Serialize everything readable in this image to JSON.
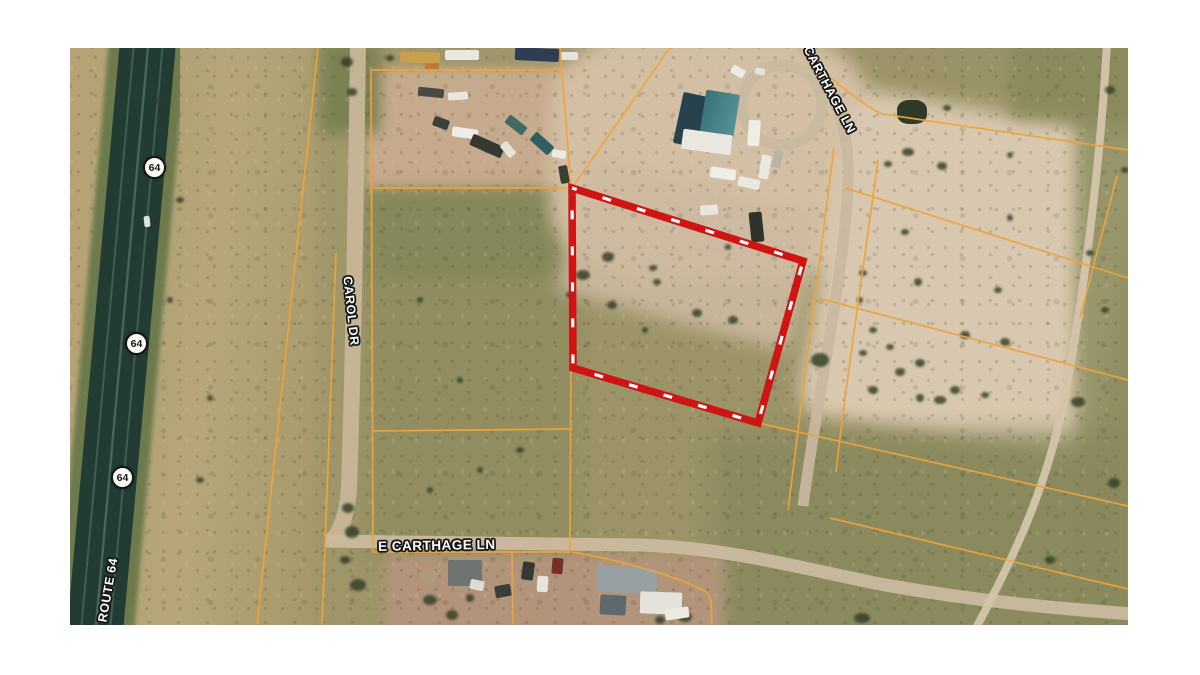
{
  "map": {
    "labels": {
      "route_64": "ROUTE 64",
      "carol_dr": "CAROL DR",
      "carthage_ln": "CARTHAGE LN",
      "e_carthage_ln": "E CARTHAGE LN"
    },
    "shields": [
      {
        "text": "64"
      },
      {
        "text": "64"
      },
      {
        "text": "64"
      }
    ],
    "colors": {
      "page_background": "#ffffff",
      "parcel_line_orange": "#eda43c",
      "boundary_red": "#cf1414",
      "boundary_dash_white": "#ffffff",
      "highway_dark_green": "#223c33",
      "dirt_road_tan": "#cbbb9e",
      "cleared_dirt": "#d8c8af",
      "scrub_olive": "#9e9569"
    }
  }
}
